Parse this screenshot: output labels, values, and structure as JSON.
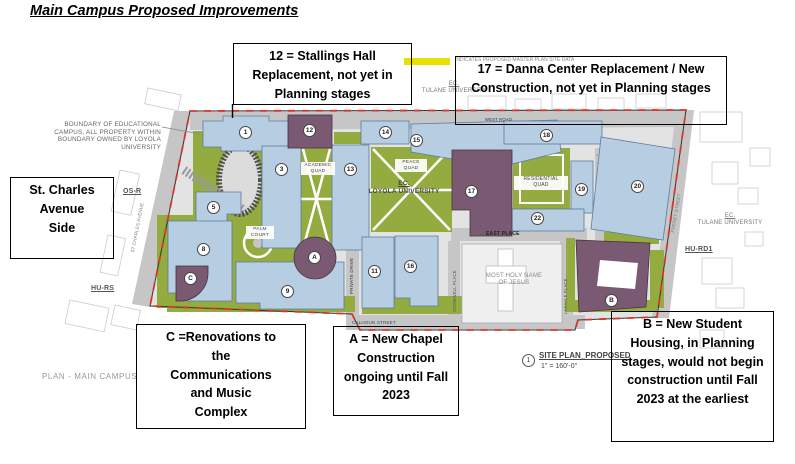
{
  "title": "Main Campus Proposed Improvements",
  "legend": {
    "text": "INDICATES PROPOSED MASTER PLAN SITE DATA",
    "swatch_color": "#e9e000"
  },
  "callouts": {
    "stallings": [
      "12 = Stallings Hall",
      "Replacement, not yet in",
      "Planning stages"
    ],
    "danna": [
      "17 = Danna Center Replacement / New",
      "Construction, not yet in Planning stages"
    ],
    "st_charles": [
      "St. Charles",
      "Avenue",
      "Side"
    ],
    "communications": [
      "C =Renovations to",
      "the",
      "Communications",
      "and Music",
      "Complex"
    ],
    "chapel": [
      "A = New Chapel",
      "Construction",
      "ongoing until Fall",
      "2023"
    ],
    "housing": [
      "B = New Student",
      "Housing, in Planning",
      "stages, would not begin",
      "construction until Fall",
      "2023 at the earliest"
    ]
  },
  "map": {
    "boundary_note": [
      "BOUNDARY OF EDUCATIONAL",
      "CAMPUS, ALL PROPERTY WITHIN",
      "BOUNDARY OWNED BY LOYOLA",
      "UNIVERSITY"
    ],
    "plan_label": "PLAN - MAIN CAMPUS",
    "site_plan": {
      "number": "1",
      "label": "SITE PLAN_PROPOSED",
      "scale": "1\" = 160'-0\""
    },
    "zones": {
      "os_r": "OS-R",
      "hu_rs": "HU-RS",
      "hu_rd1": "HU-RD1"
    },
    "institutions": {
      "tulane_top": {
        "ec": "EC.",
        "name": "TULANE UNIVERSITY"
      },
      "loyola": {
        "ec": "EC.",
        "name": "LOYOLA UNIVERSITY"
      },
      "tulane_right": {
        "ec": "EC.",
        "name": "TULANE UNIVERSITY"
      },
      "church": [
        "MOST HOLY NAME",
        "OF JESUS"
      ]
    },
    "streets": {
      "west_road": "WEST ROAD",
      "east_place": "EAST PLACE",
      "private_drive": "PRIVATE DRIVE",
      "calhoun": "CALHOUN STREET",
      "cromwell": "CROMWELL PLACE",
      "lasalle": "LASALLE PLACE",
      "freret": "FRERET STREET",
      "st_charles_ave": "ST CHARLES AVENUE"
    },
    "quads": {
      "academic": [
        "ACADEMIC",
        "QUAD"
      ],
      "peace": [
        "PEACE",
        "QUAD"
      ],
      "residential": [
        "RESIDENTIAL",
        "QUAD"
      ],
      "palm": [
        "PALM",
        "COURT"
      ]
    },
    "markers": {
      "m1": "1",
      "m3": "3",
      "m5": "5",
      "m8": "8",
      "m9": "9",
      "m11": "11",
      "m12": "12",
      "m13": "13",
      "m14": "14",
      "m15": "15",
      "m16": "16",
      "m17": "17",
      "m18": "18",
      "m19": "19",
      "m20": "20",
      "m22": "22",
      "mA": "A",
      "mB": "B",
      "mC": "C"
    },
    "colors": {
      "existing_building": "#b7cde2",
      "proposed_building": "#7a5a72",
      "green_space": "#94ab40",
      "road": "#c6c6c6",
      "boundary_dash": "#d8352c"
    }
  }
}
